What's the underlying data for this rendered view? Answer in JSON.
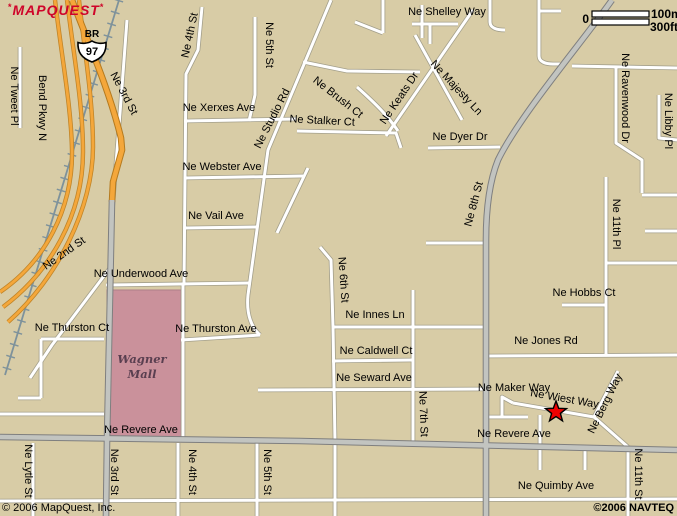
{
  "logo": {
    "text": "MAPQUEST",
    "mark_left": "*",
    "mark_right": "*",
    "color": "#cf0429"
  },
  "copyright_left": "© 2006 MapQuest, Inc.",
  "copyright_right": "©2006 NAVTEQ",
  "map": {
    "width": 677,
    "height": 516,
    "colors": {
      "background": "#d8cca6",
      "minor_road": "#ffffff",
      "major_road": "#c2c4c0",
      "highway": "#f4a73b",
      "rail": "#7e929b",
      "mall_fill": "#ca919b",
      "label": "#000000",
      "marker": "#ee0000"
    },
    "marker": {
      "name": "destination-star",
      "x": 556,
      "y": 412,
      "color": "#ee0000"
    },
    "shield": {
      "type": "US-97 business",
      "br": "BR",
      "num": "97",
      "x": 92,
      "y": 40
    },
    "scale": {
      "zero": "0",
      "top": "100m",
      "bottom": "300ft",
      "x": 592,
      "y": 11,
      "len": 57
    },
    "areas": [
      {
        "id": "wagner-mall",
        "x": 107,
        "y": 290,
        "w": 74,
        "h": 149,
        "fill": "#ca919b",
        "stroke": "#ae7e89",
        "lines": [
          "Wagner",
          "Mall"
        ],
        "lx": 142,
        "ly": 363,
        "lh": 15
      }
    ],
    "rail": {
      "d": "M119,0 L5,375"
    },
    "roads": [
      {
        "id": "bend-pkwy-lane-1",
        "cls": "hwy2",
        "d": "M55,0 C62,60 71,105 72,150 C73,210 44,262 0,292"
      },
      {
        "id": "bend-pkwy-lane-2",
        "cls": "hwy2",
        "d": "M67,0 C74,58 83,105 83,152 C83,215 50,272 3,307"
      },
      {
        "id": "bend-pkwy-lane-3",
        "cls": "hwy2",
        "d": "M79,0 C85,55 93,100 93,147 C93,207 58,278 8,322"
      },
      {
        "id": "ne-tweet-pl",
        "cls": "minor",
        "d": "M20,47 L20,128"
      },
      {
        "id": "ne-2nd-st",
        "cls": "minor",
        "d": "M127,20 L121,100 L112,215 L110,268 L52,345 L30,378"
      },
      {
        "id": "ne-4th-st-upper",
        "cls": "minor",
        "d": "M202,7 L198,50 L186,74 L184,284"
      },
      {
        "id": "ne-4th-st-mall",
        "cls": "minor",
        "d": "M183,284 L183,441"
      },
      {
        "id": "ne-5th-st-upper",
        "cls": "minor",
        "d": "M255,17 L255,95 L249,121"
      },
      {
        "id": "ne-studio-rd",
        "cls": "minor",
        "d": "M331,0 L268,150 L248,295 C246,315 252,328 260,335"
      },
      {
        "id": "ne-xerxes-ave",
        "cls": "minor",
        "d": "M184,121 L296,119"
      },
      {
        "id": "ne-webster-ave",
        "cls": "minor",
        "d": "M184,178 L303,176"
      },
      {
        "id": "webster-diagonal",
        "cls": "minor",
        "d": "M308,168 L277,233"
      },
      {
        "id": "ne-vail-ave",
        "cls": "minor",
        "d": "M184,228 L258,227"
      },
      {
        "id": "ne-underwood-ave",
        "cls": "minor",
        "d": "M106,285 L250,283"
      },
      {
        "id": "ne-thurston-ave",
        "cls": "minor",
        "d": "M181,340 L260,335"
      },
      {
        "id": "ne-thurston-ct",
        "cls": "minor",
        "d": "M41,339 L104,339 M41,339 L41,398 M18,398 L41,398"
      },
      {
        "id": "west-road",
        "cls": "minor",
        "d": "M0,414 L104,414"
      },
      {
        "id": "ne-6th-st",
        "cls": "minor",
        "d": "M320,247 L331,260 L333,327 L335,441 M335,443 L335,516"
      },
      {
        "id": "ne-innes-ln",
        "cls": "minor",
        "d": "M332,327 L486,327"
      },
      {
        "id": "ne-7th-st",
        "cls": "minor",
        "d": "M413,290 L413,441"
      },
      {
        "id": "ne-caldwell-ct",
        "cls": "minor",
        "d": "M332,361 L413,360"
      },
      {
        "id": "ne-seward-ave",
        "cls": "minor",
        "d": "M258,390 L486,389"
      },
      {
        "id": "eighth-stub-west",
        "cls": "minor",
        "d": "M426,243 L486,243"
      },
      {
        "id": "ne-hobbs-ct",
        "cls": "minor",
        "d": "M562,305 L606,305"
      },
      {
        "id": "ne-11th-pl",
        "cls": "minor",
        "d": "M606,177 L606,354 M606,263 L677,263"
      },
      {
        "id": "edge-road-1",
        "cls": "minor",
        "d": "M642,195 L677,195"
      },
      {
        "id": "edge-road-2",
        "cls": "minor",
        "d": "M645,231 L677,231"
      },
      {
        "id": "ne-jones-rd",
        "cls": "minor",
        "d": "M486,356 L677,355"
      },
      {
        "id": "ne-ravenwood-dr",
        "cls": "minor",
        "d": "M616,68 L616,143 L642,160 L642,193"
      },
      {
        "id": "top-right-road",
        "cls": "minor",
        "d": "M539,0 L539,56 C539,62 546,64 553,64 L560,64 M572,66 L677,68 M539,11 L561,11"
      },
      {
        "id": "ne-libby-pl",
        "cls": "minor",
        "d": "M659,95 L659,138 L677,140"
      },
      {
        "id": "shelley-roads",
        "cls": "minor",
        "d": "M412,24 L458,24 M430,24 L430,44 M490,0 L490,22 C490,28 497,30 505,30 M383,0 L383,33 M355,22 L383,33 M422,5 L422,38"
      },
      {
        "id": "mid-connector",
        "cls": "minor",
        "d": "M303,62 L347,71 L420,72"
      },
      {
        "id": "ne-keats-dr",
        "cls": "minor",
        "d": "M473,10 L386,136"
      },
      {
        "id": "ne-majesty-ln",
        "cls": "minor",
        "d": "M415,35 L462,120"
      },
      {
        "id": "ne-brush-ct",
        "cls": "minor",
        "d": "M357,87 C376,104 388,116 398,131"
      },
      {
        "id": "ne-stalker-ct",
        "cls": "minor",
        "d": "M297,131 L396,133 L401,148"
      },
      {
        "id": "ne-dyer-dr",
        "cls": "minor",
        "d": "M428,148 L500,147"
      },
      {
        "id": "ne-maker-way",
        "cls": "minor",
        "d": "M486,417 L528,417 M502,417 L502,397 L513,403"
      },
      {
        "id": "ne-wiest-way",
        "cls": "minor",
        "d": "M513,403 L594,417"
      },
      {
        "id": "ne-berg-way",
        "cls": "minor",
        "d": "M618,371 L594,417 L628,447"
      },
      {
        "id": "ne-11th-st",
        "cls": "minor",
        "d": "M628,447 L628,516"
      },
      {
        "id": "revere-stub-1",
        "cls": "minor",
        "d": "M540,415 L540,470"
      },
      {
        "id": "revere-stub-2",
        "cls": "minor",
        "d": "M585,448 L585,470"
      },
      {
        "id": "bottom-road",
        "cls": "minor",
        "d": "M0,501 L677,499"
      },
      {
        "id": "ne-lytle-st",
        "cls": "minor",
        "d": "M33,443 L33,516"
      },
      {
        "id": "ne-4th-st-lower",
        "cls": "minor",
        "d": "M178,443 L178,516"
      },
      {
        "id": "ne-5th-st-lower",
        "cls": "minor",
        "d": "M257,443 L257,516"
      },
      {
        "id": "ne-3rd-st-hwy",
        "cls": "hwy",
        "d": "M72,0 C86,38 108,85 121,138 L122,150 L113,182 L112,202"
      },
      {
        "id": "ne-3rd-st",
        "cls": "major",
        "d": "M112,200 L107,440 L106,516"
      },
      {
        "id": "ne-8th-st",
        "cls": "major",
        "d": "M612,0 C580,45 520,115 498,160 C490,180 486,205 486,240 L486,516"
      },
      {
        "id": "ne-revere-ave",
        "cls": "major",
        "d": "M0,437 L300,441 L677,450"
      }
    ],
    "labels": [
      {
        "t": "Ne 3rd St",
        "x": 121,
        "y": 95,
        "r": 62
      },
      {
        "t": "Bend Pkwy N",
        "x": 39,
        "y": 108,
        "r": 90
      },
      {
        "t": "Ne Tweet Pl",
        "x": 11,
        "y": 96,
        "r": 90
      },
      {
        "t": "Ne 2nd St",
        "x": 66,
        "y": 256,
        "r": -35
      },
      {
        "t": "Ne 4th St",
        "x": 193,
        "y": 36,
        "r": -78
      },
      {
        "t": "Ne 5th St",
        "x": 266,
        "y": 45,
        "r": 90
      },
      {
        "t": "Ne Studio Rd",
        "x": 275,
        "y": 120,
        "r": -63
      },
      {
        "t": "Ne Xerxes Ave",
        "x": 219,
        "y": 111,
        "r": 0
      },
      {
        "t": "Ne Shelley Way",
        "x": 447,
        "y": 15,
        "r": 0
      },
      {
        "t": "Ne Brush Ct",
        "x": 336,
        "y": 100,
        "r": 38
      },
      {
        "t": "Ne Stalker Ct",
        "x": 322,
        "y": 124,
        "r": 3
      },
      {
        "t": "Ne Majesty Ln",
        "x": 454,
        "y": 90,
        "r": 47
      },
      {
        "t": "Ne Keats Dr",
        "x": 402,
        "y": 100,
        "r": -56
      },
      {
        "t": "Ne Dyer Dr",
        "x": 460,
        "y": 140,
        "r": 0
      },
      {
        "t": "Ne 8th St",
        "x": 477,
        "y": 205,
        "r": -75
      },
      {
        "t": "Ne Ravenwood Dr",
        "x": 622,
        "y": 98,
        "r": 90
      },
      {
        "t": "Ne Libby Pl",
        "x": 665,
        "y": 121,
        "r": 90
      },
      {
        "t": "Ne Webster Ave",
        "x": 222,
        "y": 170,
        "r": 0
      },
      {
        "t": "Ne Vail Ave",
        "x": 216,
        "y": 219,
        "r": 0
      },
      {
        "t": "Ne 11th Pl",
        "x": 613,
        "y": 224,
        "r": 90
      },
      {
        "t": "Ne Underwood Ave",
        "x": 141,
        "y": 277,
        "r": 0
      },
      {
        "t": "Ne 6th St",
        "x": 340,
        "y": 280,
        "r": 86
      },
      {
        "t": "Ne Hobbs Ct",
        "x": 584,
        "y": 296,
        "r": 0
      },
      {
        "t": "Ne Thurston Ct",
        "x": 72,
        "y": 331,
        "r": 0
      },
      {
        "t": "Ne Thurston Ave",
        "x": 216,
        "y": 332,
        "r": 0
      },
      {
        "t": "Ne Innes Ln",
        "x": 375,
        "y": 318,
        "r": 0
      },
      {
        "t": "Ne Jones Rd",
        "x": 546,
        "y": 344,
        "r": 0
      },
      {
        "t": "Ne Caldwell Ct",
        "x": 376,
        "y": 354,
        "r": 0
      },
      {
        "t": "Ne Seward Ave",
        "x": 374,
        "y": 381,
        "r": 0
      },
      {
        "t": "Ne Maker Way",
        "x": 514,
        "y": 391,
        "r": 0
      },
      {
        "t": "Ne Wiest Way",
        "x": 564,
        "y": 402,
        "r": 10
      },
      {
        "t": "Ne Berg Way",
        "x": 608,
        "y": 405,
        "r": -64
      },
      {
        "t": "Ne 7th St",
        "x": 420,
        "y": 414,
        "r": 88
      },
      {
        "t": "Ne Revere Ave",
        "x": 141,
        "y": 433,
        "r": 0
      },
      {
        "t": "Ne Revere Ave",
        "x": 514,
        "y": 437,
        "r": 0
      },
      {
        "t": "Ne Quimby Ave",
        "x": 556,
        "y": 489,
        "r": 0
      },
      {
        "t": "Ne 11th St",
        "x": 635,
        "y": 474,
        "r": 90
      },
      {
        "t": "Ne Lytle St",
        "x": 25,
        "y": 471,
        "r": 90
      },
      {
        "t": "Ne 3rd St",
        "x": 111,
        "y": 472,
        "r": 90
      },
      {
        "t": "Ne 4th St",
        "x": 189,
        "y": 472,
        "r": 90
      },
      {
        "t": "Ne 5th St",
        "x": 264,
        "y": 472,
        "r": 90
      }
    ]
  }
}
